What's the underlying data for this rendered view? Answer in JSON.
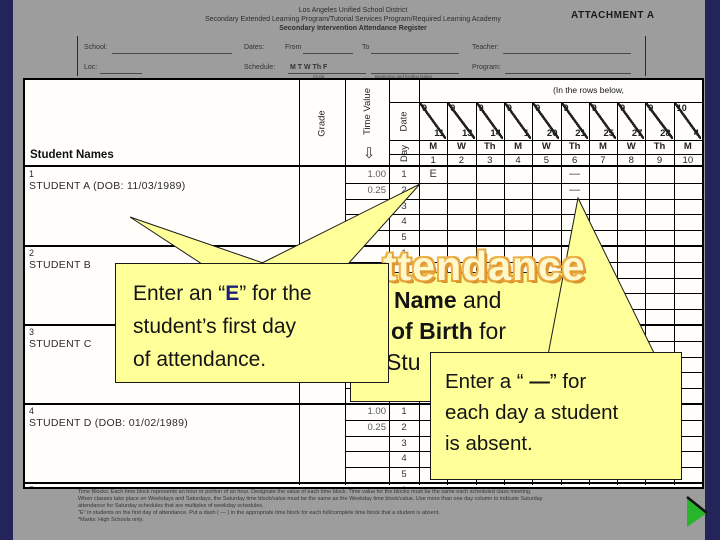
{
  "colors": {
    "slide_navy": "#23255a",
    "scan_gray": "#9d9d9d",
    "callout_yellow": "#ffff99",
    "accent_blue": "#1b1f7a",
    "wordart_orange": "#e8a53c",
    "arrow_green": "#28b52b"
  },
  "form": {
    "attachment": "ATTACHMENT A",
    "title_lines": [
      "Los Angeles Unified School District",
      "Secondary Extended Learning Program/Tutorial Services Program/Required Learning Academy",
      "Secondary Intervention Attendance Register"
    ],
    "fields": {
      "school": "School:",
      "loc": "Loc:",
      "dates": "Dates:",
      "from": "From",
      "to": "To",
      "schedule": "Schedule:",
      "week_days": "M   T   W   Th   F",
      "circle_caption": "Circle",
      "dates_caption": "Beginning and Ending Dates",
      "teacher": "Teacher:",
      "program": "Program:"
    }
  },
  "sheet": {
    "note": "(In the rows below,",
    "student_names_header": "Student Names",
    "col_headers": {
      "grade": "Grade",
      "time_value": "Time Value",
      "date": "Date",
      "day": "Day"
    },
    "dates": [
      {
        "m": "9",
        "d": "11"
      },
      {
        "m": "9",
        "d": "13"
      },
      {
        "m": "9",
        "d": "14"
      },
      {
        "m": "9",
        "d": "1"
      },
      {
        "m": "9",
        "d": "20"
      },
      {
        "m": "9",
        "d": "21"
      },
      {
        "m": "9",
        "d": "25"
      },
      {
        "m": "9",
        "d": "27"
      },
      {
        "m": "9",
        "d": "28"
      },
      {
        "m": "10",
        "d": "4"
      }
    ],
    "day_letters": [
      "M",
      "W",
      "Th",
      "M",
      "W",
      "Th",
      "M",
      "W",
      "Th",
      "M"
    ],
    "day_numbers": [
      "1",
      "2",
      "3",
      "4",
      "5",
      "6",
      "7",
      "8",
      "9",
      "10"
    ],
    "students": [
      {
        "num": "1",
        "name": "STUDENT A (DOB: 11/03/1989)",
        "time_values": [
          "1.00",
          "0.25"
        ],
        "marks": [
          {
            "day": 1,
            "block": 1,
            "symbol": "E"
          },
          {
            "day": 6,
            "block": 1,
            "symbol": "—"
          },
          {
            "day": 6,
            "block": 2,
            "symbol": "—"
          }
        ]
      },
      {
        "num": "2",
        "name": "STUDENT B",
        "time_values": [],
        "marks": []
      },
      {
        "num": "3",
        "name": "STUDENT C",
        "time_values": [],
        "marks": []
      },
      {
        "num": "4",
        "name": "STUDENT D (DOB: 01/02/1989)",
        "time_values": [
          "1.00",
          "0.25"
        ],
        "marks": []
      },
      {
        "num": "5",
        "name": "",
        "time_values": [],
        "marks": []
      }
    ],
    "blocks_per_student": [
      "1",
      "2",
      "3",
      "4",
      "5"
    ]
  },
  "callouts": {
    "c1": {
      "l1a": "Enter an “",
      "e": "E",
      "l1b": "” for the",
      "l2": "student’s first day",
      "l3": "of attendance."
    },
    "c2": {
      "f1_bold": "Name",
      "f1_rest": " and",
      "f2_bold": "of Birth",
      "f2_rest": " for",
      "f3": "Stu"
    },
    "c3": {
      "l1a": "Enter a “ ",
      "dash": "—",
      "l1b": "” for",
      "l2": "each day a student",
      "l3": "is absent."
    },
    "big_text": "ttendance"
  },
  "footer": {
    "lines": [
      "Time Blocks: Each time block represents an hour or portion of an hour. Designate the value of each time block. Time value for the blocks must be the same each scheduled class meeting.",
      "When classes take place on Weekdays and Saturdays, the Saturday time block/value must be the same as the Weekday time block/value. Use more than one day column to indicate Saturday",
      "attendance for Saturday schedules that are multiples of weekday schedules.",
      "\"E\" in students on the first day of attendance. Put a dash ( — ) in the appropriate time block for each full/complete time block that a student is absent.",
      "*Marks: High Schools only."
    ]
  }
}
